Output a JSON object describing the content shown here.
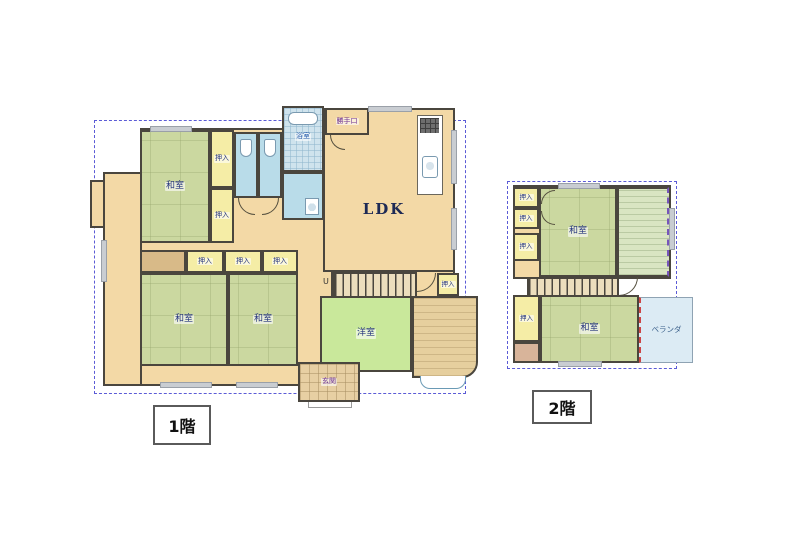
{
  "floor1": {
    "floor_label": "1階",
    "rooms": {
      "washitsu_nw": "和室",
      "washitsu_sw_left": "和室",
      "washitsu_sw_right": "和室",
      "ldk": "LDK",
      "youshitsu": "洋室",
      "bath": "浴室",
      "back_door": "勝手口",
      "entrance": "玄関",
      "stairs_up_mark": "U"
    },
    "closets": {
      "north_col_upper": "押入",
      "north_col_lower": "押入",
      "mid_row_1": "押入",
      "mid_row_2": "押入",
      "mid_row_3": "押入",
      "by_stairs": "押入"
    }
  },
  "floor2": {
    "floor_label": "2階",
    "rooms": {
      "washitsu_north": "和室",
      "washitsu_south": "和室",
      "veranda": "ベランダ"
    },
    "closets": {
      "west_col_1": "押入",
      "west_col_2": "押入",
      "west_col_3": "押入",
      "south_west": "押入"
    }
  },
  "colors": {
    "tatami_room": "#cbd8a0",
    "western_room": "#c9e89b",
    "wood_floor": "#f3d9a6",
    "closet": "#f5eda6",
    "wet_area": "#b9dce9",
    "veranda": "#dcebf4",
    "tokonoma": "#d8ba88",
    "wall": "#4a463e",
    "boundary_dash": "#5b5bd6",
    "label_text": "#26357e"
  }
}
